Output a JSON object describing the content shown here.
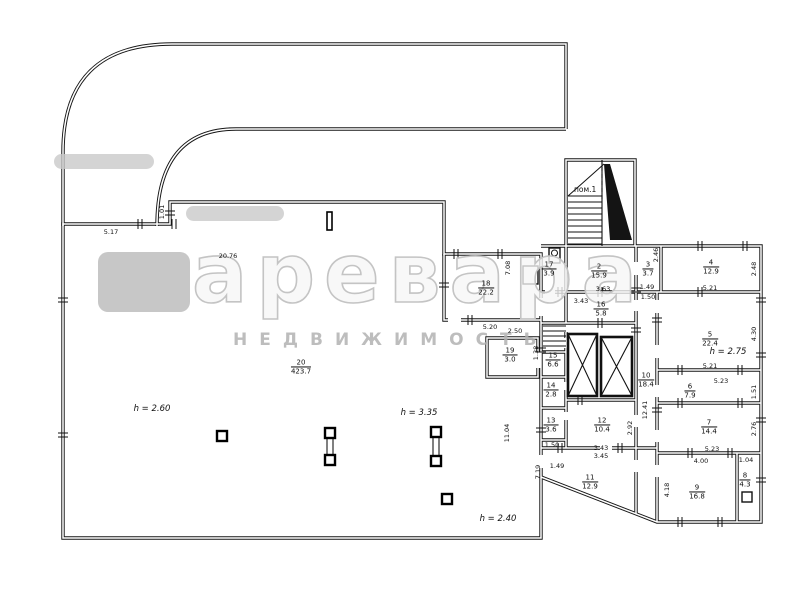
{
  "watermark": {
    "brand_text": "аревара",
    "subtitle": "НЕДВИЖИМОСТЬ"
  },
  "stairwell": {
    "label": "пом.1"
  },
  "rooms": [
    {
      "num": "20",
      "area": "423.7",
      "x": 301,
      "y": 367
    },
    {
      "num": "17",
      "area": "3.9",
      "x": 549,
      "y": 269
    },
    {
      "num": "2",
      "area": "15.9",
      "x": 599,
      "y": 271
    },
    {
      "num": "3",
      "area": "3.7",
      "x": 648,
      "y": 269
    },
    {
      "num": "4",
      "area": "12.9",
      "x": 711,
      "y": 267
    },
    {
      "num": "18",
      "area": "22.2",
      "x": 486,
      "y": 288
    },
    {
      "num": "16",
      "area": "5.8",
      "x": 601,
      "y": 309
    },
    {
      "num": "5",
      "area": "22.4",
      "x": 710,
      "y": 339
    },
    {
      "num": "19",
      "area": "3.0",
      "x": 510,
      "y": 355
    },
    {
      "num": "15",
      "area": "6.6",
      "x": 553,
      "y": 360
    },
    {
      "num": "14",
      "area": "2.8",
      "x": 551,
      "y": 390
    },
    {
      "num": "10",
      "area": "18.4",
      "x": 646,
      "y": 380
    },
    {
      "num": "6",
      "area": "7.9",
      "x": 690,
      "y": 391
    },
    {
      "num": "13",
      "area": "3.6",
      "x": 551,
      "y": 425
    },
    {
      "num": "12",
      "area": "10.4",
      "x": 602,
      "y": 425
    },
    {
      "num": "7",
      "area": "14.4",
      "x": 709,
      "y": 427
    },
    {
      "num": "11",
      "area": "12.9",
      "x": 590,
      "y": 482
    },
    {
      "num": "9",
      "area": "16.8",
      "x": 697,
      "y": 492
    },
    {
      "num": "8",
      "area": "4.3",
      "x": 745,
      "y": 480
    }
  ],
  "dimensions": [
    {
      "text": "5.17",
      "x": 111,
      "y": 232,
      "rot": false
    },
    {
      "text": "1.01",
      "x": 162,
      "y": 212,
      "rot": true
    },
    {
      "text": "20.76",
      "x": 228,
      "y": 256,
      "rot": false
    },
    {
      "text": "7.08",
      "x": 508,
      "y": 268,
      "rot": true
    },
    {
      "text": "5.20",
      "x": 490,
      "y": 327,
      "rot": false
    },
    {
      "text": "2.50",
      "x": 515,
      "y": 331,
      "rot": false
    },
    {
      "text": "1.38",
      "x": 536,
      "y": 353,
      "rot": true
    },
    {
      "text": "3.43",
      "x": 581,
      "y": 301,
      "rot": false
    },
    {
      "text": "3.63",
      "x": 603,
      "y": 289,
      "rot": false
    },
    {
      "text": "1.49",
      "x": 647,
      "y": 287,
      "rot": false
    },
    {
      "text": "1.50",
      "x": 648,
      "y": 297,
      "rot": false
    },
    {
      "text": "2.46",
      "x": 656,
      "y": 255,
      "rot": true
    },
    {
      "text": "5.21",
      "x": 710,
      "y": 288,
      "rot": false
    },
    {
      "text": "2.48",
      "x": 754,
      "y": 269,
      "rot": true
    },
    {
      "text": "5.21",
      "x": 710,
      "y": 366,
      "rot": false
    },
    {
      "text": "4.30",
      "x": 754,
      "y": 334,
      "rot": true
    },
    {
      "text": "5.23",
      "x": 721,
      "y": 381,
      "rot": false
    },
    {
      "text": "1.51",
      "x": 754,
      "y": 392,
      "rot": true
    },
    {
      "text": "5.23",
      "x": 712,
      "y": 449,
      "rot": false
    },
    {
      "text": "2.76",
      "x": 754,
      "y": 429,
      "rot": true
    },
    {
      "text": "4.00",
      "x": 701,
      "y": 461,
      "rot": false
    },
    {
      "text": "1.04",
      "x": 746,
      "y": 460,
      "rot": false
    },
    {
      "text": "4.18",
      "x": 667,
      "y": 490,
      "rot": true
    },
    {
      "text": "3.43",
      "x": 601,
      "y": 448,
      "rot": false
    },
    {
      "text": "3.45",
      "x": 601,
      "y": 456,
      "rot": false
    },
    {
      "text": "1.50",
      "x": 552,
      "y": 445,
      "rot": false
    },
    {
      "text": "1.49",
      "x": 557,
      "y": 466,
      "rot": false
    },
    {
      "text": "2.92",
      "x": 630,
      "y": 428,
      "rot": true
    },
    {
      "text": "12.41",
      "x": 645,
      "y": 410,
      "rot": true
    },
    {
      "text": "7.19",
      "x": 538,
      "y": 472,
      "rot": true
    },
    {
      "text": "11.04",
      "x": 507,
      "y": 433,
      "rot": true
    }
  ],
  "heights": [
    {
      "text": "h = 2.60",
      "x": 152,
      "y": 409
    },
    {
      "text": "h = 3.35",
      "x": 419,
      "y": 413
    },
    {
      "text": "h = 2.75",
      "x": 728,
      "y": 352
    },
    {
      "text": "h = 2.40",
      "x": 498,
      "y": 519
    }
  ]
}
